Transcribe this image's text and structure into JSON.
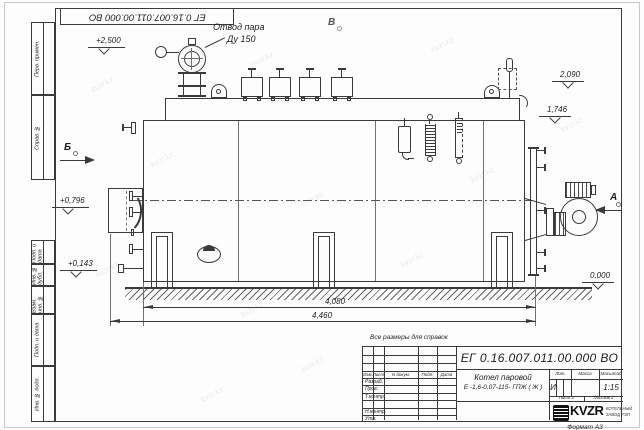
{
  "stamp": {
    "doc_number": "ЕГ 0.16.007.011.00.000  ВО",
    "product_name_line1": "Котел паровой",
    "product_name_line2": "Е -1,6-0,07-115- ГПЖ ( Ж )",
    "note_above": "Все размеры для справок",
    "format": "Формат  А3",
    "headers": {
      "izm": "Изм.",
      "list": "Лист",
      "ndoc": "N докум.",
      "podp": "Подп.",
      "data": "Дата",
      "lit": "Лит.",
      "mass": "Масса",
      "scale": "Масштаб"
    },
    "rows": {
      "r0": "Разраб.",
      "r1": "Пров.",
      "r2": "Т.контр.",
      "r3": "Н.контр.",
      "r4": "Утв."
    },
    "lit_value": "И",
    "scale_value": "1:15",
    "sheet": "Лист 1",
    "sheets": "Листов 2",
    "logo": {
      "brand": "KVZR",
      "line1": "КОТЕЛЬНЫЙ",
      "line2": "ЗАВОД РЭП"
    }
  },
  "margin_labels": {
    "a": "Перв. примен.",
    "b": "Справ. №",
    "c": "Подп. и дата",
    "d": "Инв. № дубл.",
    "e": "Взам. инв. №",
    "f": "Подп. и дата",
    "g": "Инв. № подл."
  },
  "callouts": {
    "steam_line1": "Отвод пара",
    "steam_line2": "Ду 150",
    "view_a": "А",
    "view_b": "Б",
    "view_v": "В"
  },
  "elevations": {
    "e2500": "+2,500",
    "e2090": "2,090",
    "e1746": "1,746",
    "e0796": "+0,796",
    "e0143": "+0,143",
    "e0000": "0,000"
  },
  "dimensions": {
    "d1": "4,080",
    "d2": "4,460"
  },
  "watermark": "kvzr.kz",
  "colors": {
    "line": "#3a3a3a",
    "background": "#fdfdfd",
    "watermark": "rgba(100,125,140,0.14)"
  }
}
